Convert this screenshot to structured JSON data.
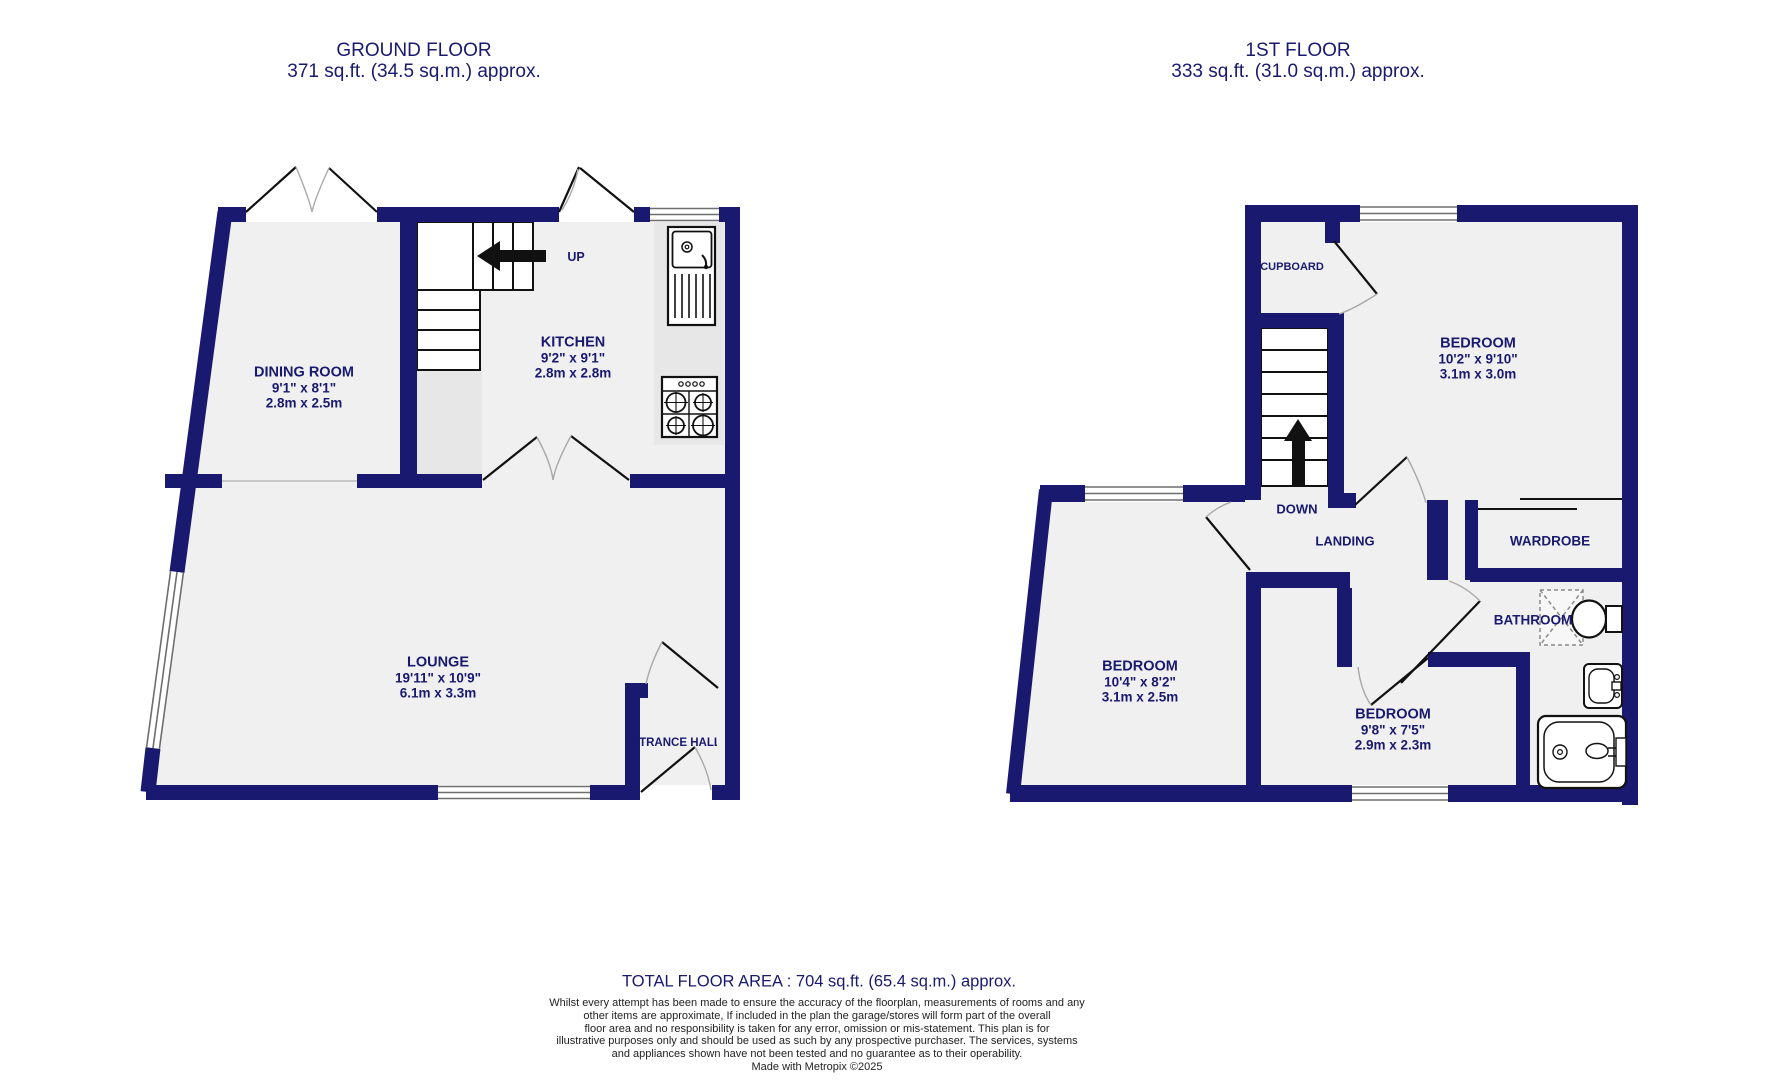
{
  "ground_floor": {
    "title": "GROUND FLOOR",
    "subtitle": "371 sq.ft. (34.5 sq.m.) approx.",
    "stair_direction": "UP",
    "rooms": {
      "dining": {
        "name": "DINING ROOM",
        "imperial": "9'1\" x 8'1\"",
        "metric": "2.8m x 2.5m"
      },
      "kitchen": {
        "name": "KITCHEN",
        "imperial": "9'2\" x 9'1\"",
        "metric": "2.8m x 2.8m"
      },
      "lounge": {
        "name": "LOUNGE",
        "imperial": "19'11\" x 10'9\"",
        "metric": "6.1m x 3.3m"
      },
      "entrance": {
        "name": "ENTRANCE HALL"
      }
    }
  },
  "first_floor": {
    "title": "1ST FLOOR",
    "subtitle": "333 sq.ft. (31.0 sq.m.) approx.",
    "stair_direction": "DOWN",
    "rooms": {
      "cupboard": {
        "name": "CUPBOARD"
      },
      "bedroom_top": {
        "name": "BEDROOM",
        "imperial": "10'2\" x 9'10\"",
        "metric": "3.1m x 3.0m"
      },
      "landing": {
        "name": "LANDING"
      },
      "wardrobe": {
        "name": "WARDROBE"
      },
      "bathroom": {
        "name": "BATHROOM"
      },
      "bedroom_left": {
        "name": "BEDROOM",
        "imperial": "10'4\" x 8'2\"",
        "metric": "3.1m x 2.5m"
      },
      "bedroom_middle": {
        "name": "BEDROOM",
        "imperial": "9'8\" x 7'5\"",
        "metric": "2.9m x 2.3m"
      }
    }
  },
  "footer": {
    "total_area": "TOTAL FLOOR AREA : 704 sq.ft. (65.4 sq.m.) approx.",
    "disclaimer_lines": [
      "Whilst every attempt has been made to ensure the accuracy of the floorplan, measurements of rooms and any",
      "other items are approximate, If included in the plan the garage/stores will form part of the overall",
      "floor area and no responsibility is taken for any error, omission or mis-statement. This plan is for",
      "illustrative purposes only and should be used as such by any prospective purchaser. The services, systems",
      "and appliances shown have not been tested and no guarantee as to their operability."
    ],
    "credit": "Made with Metropix ©2025"
  },
  "icons": [
    "kitchen-sink-icon",
    "hob-icon",
    "shower-icon",
    "toilet-icon",
    "basin-icon",
    "bathtub-icon",
    "stairs-up-arrow-icon",
    "stairs-down-arrow-icon"
  ],
  "colors": {
    "wall": "#191970",
    "floor": "#f0f0f0",
    "counter": "#e7e7e7",
    "label_text": "#191970",
    "disclaimer_text": "#222222"
  }
}
